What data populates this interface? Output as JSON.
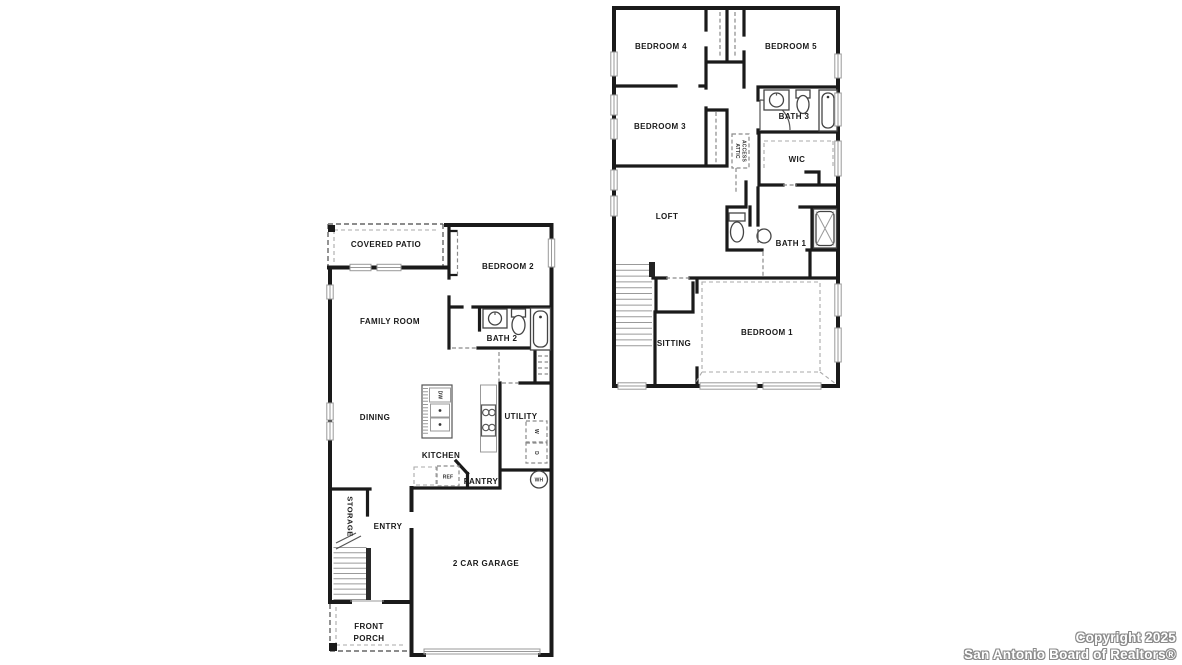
{
  "floor1": {
    "covered_patio": "COVERED PATIO",
    "bedroom2": "BEDROOM 2",
    "family_room": "FAMILY ROOM",
    "bath2": "BATH 2",
    "dining": "DINING",
    "kitchen": "KITCHEN",
    "utility": "UTILITY",
    "pantry": "PANTRY",
    "ref": "REF",
    "dw": "DW",
    "washer": "W",
    "dryer": "D",
    "wh": "WH",
    "storage": "STORAGE",
    "entry": "ENTRY",
    "garage": "2 CAR GARAGE",
    "front_porch_line1": "FRONT",
    "front_porch_line2": "PORCH"
  },
  "floor2": {
    "bedroom4": "BEDROOM 4",
    "bedroom5": "BEDROOM 5",
    "bedroom3": "BEDROOM 3",
    "bath3": "BATH 3",
    "attic_line1": "ATTIC",
    "attic_line2": "ACCESS",
    "wic": "WIC",
    "loft": "LOFT",
    "bath1": "BATH 1",
    "sitting": "SITTING",
    "bedroom1": "BEDROOM 1"
  },
  "footer": {
    "line1": "Copyright 2025",
    "line2": "San Antonio Board of Realtors®"
  },
  "colors": {
    "wall": "#1a1a1a",
    "label": "#1a1a1a",
    "dashed": "#8a8a8a",
    "window": "#999999",
    "watermark_fill": "#ffffff",
    "watermark_outline": "#8a8a8a",
    "background": "#ffffff"
  }
}
